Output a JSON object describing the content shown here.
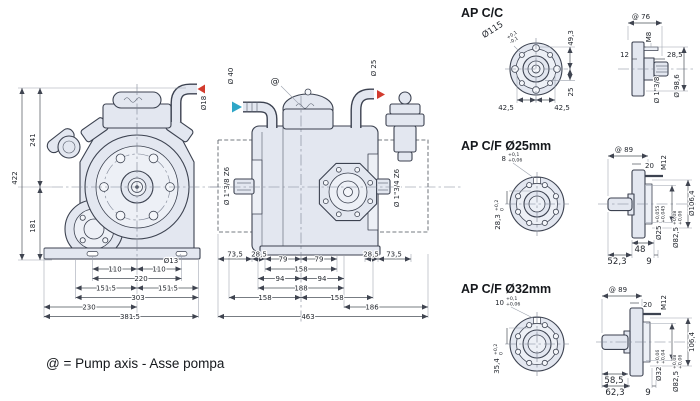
{
  "palette": {
    "body_fill": "#e3e7f0",
    "line": "#3c4250",
    "dim_line": "#4a5059",
    "red_arrow": "#d23b2e",
    "blue_arrow": "#2fa6c7"
  },
  "footnote": {
    "text": "@ = Pump axis - Asse pompa"
  },
  "front": {
    "v422": "422",
    "v241": "241",
    "v181": "181",
    "d18": "Ø18",
    "d13": "Ø13",
    "b110l": "110",
    "b110r": "110",
    "b220": "220",
    "b1515l": "151.5",
    "b1515r": "151.5",
    "b303": "303",
    "b230": "230",
    "b3815": "381.5"
  },
  "side": {
    "d40": "Ø 40",
    "d25": "Ø 25",
    "axis": "@",
    "spline_left": "Ø 1\"3/8 Z6",
    "spline_right": "Ø 1\"3/4 Z6",
    "b735l": "73,5",
    "b285l": "28,5",
    "b79l": "79",
    "b79r": "79",
    "b158t": "158",
    "b94l": "94",
    "b94r": "94",
    "b188": "188",
    "b158l": "158",
    "b158r": "158",
    "b186": "186",
    "b285r": "28,5",
    "b735r": "73,5",
    "b463": "463"
  },
  "cc": {
    "title": "AP C/C",
    "d115": "Ø115",
    "tol_top": "+0,1",
    "tol_bot": "-0,1",
    "v493": "49,3",
    "v25": "25",
    "b425l": "42,5",
    "b425r": "42,5",
    "at76": "@ 76",
    "m8": "M8",
    "v12": "12",
    "v285": "28,5",
    "spline": "Ø 1\"3/8",
    "d986": "Ø 98,6"
  },
  "cf25": {
    "title": "AP C/F Ø25mm",
    "key": "8",
    "key_tol_top": "+0,1",
    "key_tol_bot": "+0,06",
    "v283": "28,3",
    "v283_tol_top": "+0,2",
    "v283_tol_bot": "0",
    "at89": "@ 89",
    "v20": "20",
    "m12": "M12",
    "d1064": "Ø106,4",
    "v48": "48",
    "v523": "52,3",
    "v9": "9",
    "d25": "Ø25",
    "d25_tol_top": "+0,055",
    "d25_tol_bot": "+0,045",
    "d825": "Ø82,5",
    "d825_tol_top": "+0,08",
    "d825_tol_bot": "+0,06"
  },
  "cf32": {
    "title": "AP C/F Ø32mm",
    "key": "10",
    "key_tol_top": "+0,1",
    "key_tol_bot": "+0,06",
    "v354": "35,4",
    "v354_tol_top": "+0,2",
    "v354_tol_bot": "0",
    "at89": "@ 89",
    "v20": "20",
    "m12": "M12",
    "d1064": "106,4",
    "v585": "58,5",
    "v623": "62,3",
    "v9": "9",
    "d32": "Ø32",
    "d32_tol_top": "+0,06",
    "d32_tol_bot": "+0,04",
    "d825": "Ø82,5",
    "d825_tol_top": "+0,08",
    "d825_tol_bot": "+0,06"
  }
}
